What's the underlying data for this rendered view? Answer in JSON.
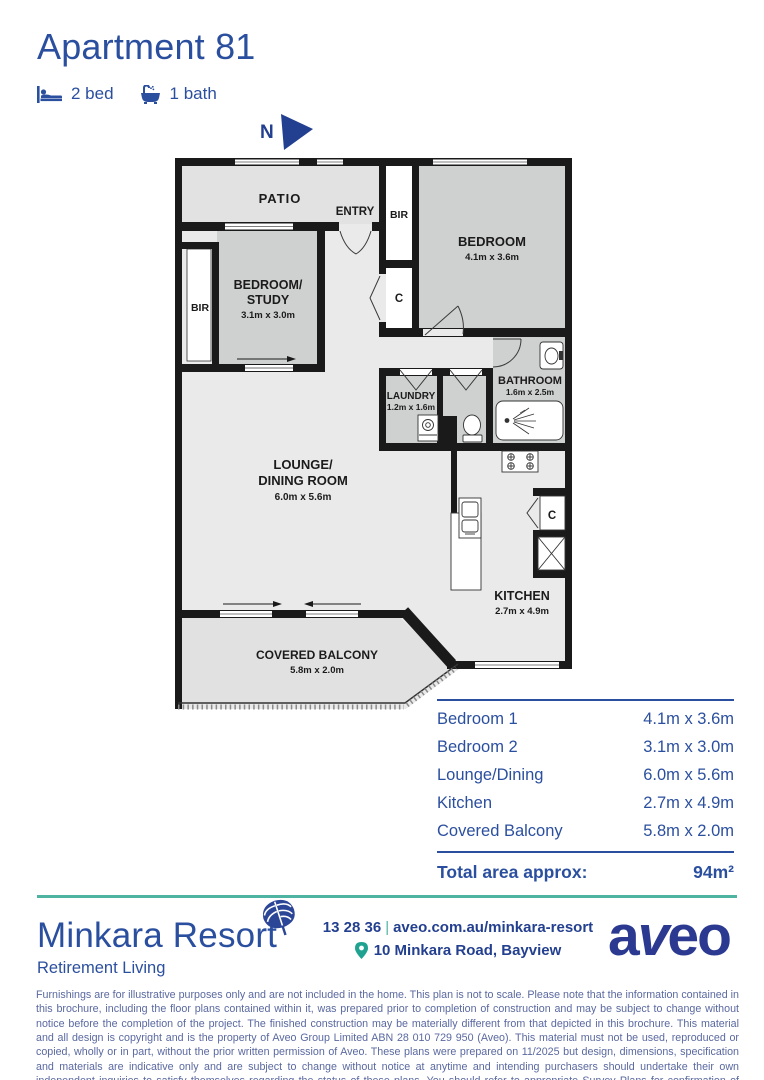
{
  "header": {
    "title": "Apartment 81",
    "beds_label": "2 bed",
    "baths_label": "1 bath",
    "north_label": "N"
  },
  "colors": {
    "accent_blue": "#2b4f9f",
    "navy_logo": "#2b3a90",
    "teal": "#4fb3a2",
    "disclaimer_blue": "#5a69a0",
    "wall_black": "#1a1a1a",
    "room_gray": "#cfd0d0",
    "floor_gray": "#eaeaea"
  },
  "floorplan": {
    "patio_label": "PATIO",
    "entry_label": "ENTRY",
    "bir_left_label": "BIR",
    "bedroom_study_label1": "BEDROOM/",
    "bedroom_study_label2": "STUDY",
    "bedroom_study_dims": "3.1m x 3.0m",
    "bir_bedroom_label": "BIR",
    "cupboard_hall_label": "C",
    "bedroom_label": "BEDROOM",
    "bedroom_dims": "4.1m x 3.6m",
    "bathroom_label": "BATHROOM",
    "bathroom_dims": "1.6m x 2.5m",
    "laundry_label": "LAUNDRY",
    "laundry_dims": "1.2m x 1.6m",
    "lounge_label1": "LOUNGE/",
    "lounge_label2": "DINING ROOM",
    "lounge_dims": "6.0m x 5.6m",
    "kitchen_label": "KITCHEN",
    "kitchen_dims": "2.7m x 4.9m",
    "cupboard_kitchen_label": "C",
    "balcony_label": "COVERED BALCONY",
    "balcony_dims": "5.8m x 2.0m"
  },
  "dimensions_table": {
    "rows": [
      {
        "name": "Bedroom 1",
        "size": "4.1m x 3.6m"
      },
      {
        "name": "Bedroom 2",
        "size": "3.1m x 3.0m"
      },
      {
        "name": "Lounge/Dining",
        "size": "6.0m x 5.6m"
      },
      {
        "name": "Kitchen",
        "size": "2.7m x 4.9m"
      },
      {
        "name": "Covered Balcony",
        "size": "5.8m x 2.0m"
      }
    ],
    "total_label": "Total area approx:",
    "total_value": "94m²"
  },
  "footer": {
    "brand_name": "Minkara Resort",
    "brand_sub": "Retirement Living",
    "phone": "13 28 36",
    "separator": "|",
    "website": "aveo.com.au/minkara-resort",
    "address": "10 Minkara Road, Bayview",
    "logo_a": "a",
    "logo_v": "v",
    "logo_eo": "eo"
  },
  "disclaimer": "Furnishings are for illustrative purposes only and are not included in the home. This plan is not to scale. Please note that the information contained in this brochure, including the floor plans contained within it, was prepared prior to completion of construction and may be subject to change without notice before the completion of the project. The finished construction may be materially different from that depicted in this brochure. This material and all design is copyright and is the property of Aveo Group Limited ABN 28 010 729 950 (Aveo). This material must not be used, reproduced or copied, wholly or in part, without the prior written permission of Aveo. These plans were prepared on 11/2025 but design, dimensions, specification and materials are indicative only and are subject to change without notice at anytime and intending purchasers should undertake their own independent inquiries to satisfy themselves regarding the status of these plans. You should refer to appropriate Survey Plans for confirmation of individual unit areas."
}
